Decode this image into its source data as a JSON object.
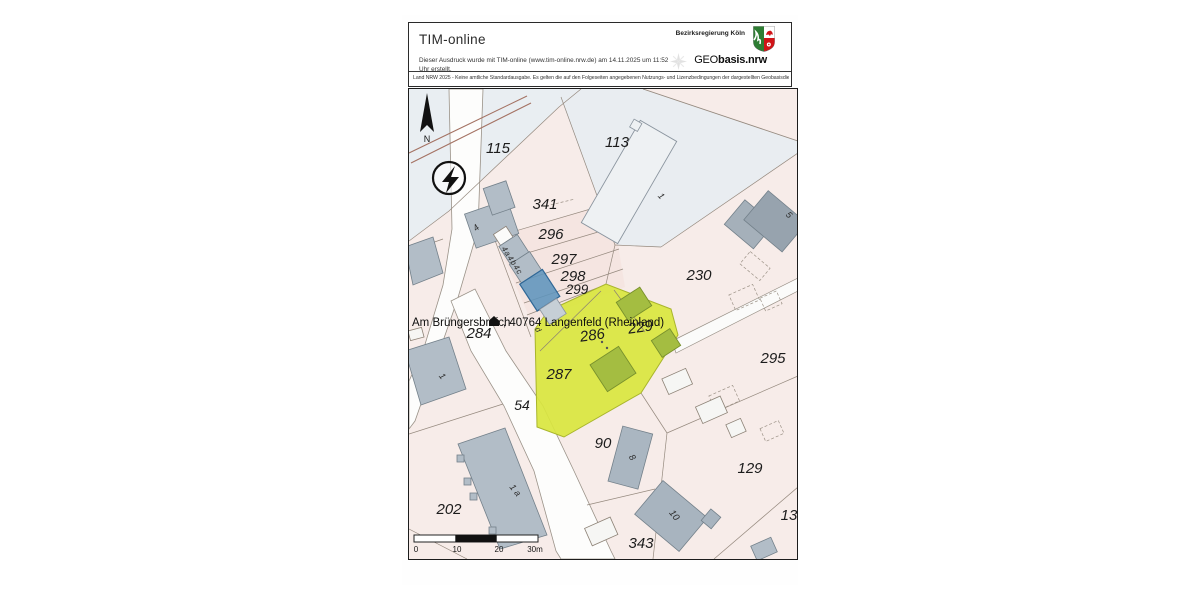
{
  "header": {
    "title": "TIM-online",
    "print_note_line1": "Dieser Ausdruck wurde mit TIM-online (www.tim-online.nrw.de) am 14.11.2025 um 11:52",
    "print_note_line2": "Uhr erstellt.",
    "agency": "Bezirksregierung Köln",
    "logo_prefix": "GEO",
    "logo_suffix": "basis.nrw",
    "disclaimer": "Land NRW 2025 - Keine amtliche Standardausgabe. Es gelten die auf den Folgeseiten angegebenen Nutzungs- und Lizenzbedingungen der dargestellten Geobasisdienste."
  },
  "map": {
    "north_label": "N",
    "address": {
      "part1": "Am Brüngersbroich",
      "part2": ", 40764 Langenfeld (Rheinland)",
      "marker_icon": "house-marker-icon"
    },
    "colors": {
      "parcel_pink": "#f7ece9",
      "street_area_blue": "#e9eef2",
      "highlight_parcels_yellow": "#d9e63e",
      "highlight_building_blue": "#5e94bc",
      "building_gray": "#b2bdc7",
      "building_in_highlight_olive": "#a4bd41"
    },
    "parcel_labels": [
      {
        "text": "115",
        "x": 89,
        "y": 64
      },
      {
        "text": "113",
        "x": 208,
        "y": 58
      },
      {
        "text": "341",
        "x": 136,
        "y": 120
      },
      {
        "text": "296",
        "x": 142,
        "y": 150
      },
      {
        "text": "297",
        "x": 155,
        "y": 175
      },
      {
        "text": "298",
        "x": 164,
        "y": 192
      },
      {
        "text": "299",
        "x": 168,
        "y": 205,
        "size": 13.5
      },
      {
        "text": "230",
        "x": 290,
        "y": 191
      },
      {
        "text": "284",
        "x": 70,
        "y": 249
      },
      {
        "text": "286",
        "x": 184,
        "y": 251,
        "rot": -8
      },
      {
        "text": "229",
        "x": 232,
        "y": 243,
        "rot": -8
      },
      {
        "text": "295",
        "x": 364,
        "y": 274
      },
      {
        "text": "287",
        "x": 150,
        "y": 290
      },
      {
        "text": "54",
        "x": 113,
        "y": 321,
        "size": 14
      },
      {
        "text": "90",
        "x": 194,
        "y": 359
      },
      {
        "text": "129",
        "x": 341,
        "y": 384
      },
      {
        "text": "202",
        "x": 40,
        "y": 425
      },
      {
        "text": "343",
        "x": 232,
        "y": 459
      },
      {
        "text": "13",
        "x": 380,
        "y": 431
      }
    ],
    "house_numbers": [
      {
        "text": "4",
        "x": 69,
        "y": 141,
        "rot": -42
      },
      {
        "text": "1",
        "x": 250,
        "y": 109,
        "rot": 48
      },
      {
        "text": "5",
        "x": 378,
        "y": 128,
        "rot": 44
      },
      {
        "text": "4a4b4c",
        "x": 101,
        "y": 173,
        "rot": 57,
        "size": 8,
        "ls": 1
      },
      {
        "text": "d",
        "x": 127,
        "y": 242,
        "rot": 57,
        "size": 8
      },
      {
        "text": "1",
        "x": 31,
        "y": 289,
        "rot": 52
      },
      {
        "text": "1 a",
        "x": 104,
        "y": 403,
        "rot": 52
      },
      {
        "text": "8",
        "x": 221,
        "y": 370,
        "rot": 55
      },
      {
        "text": "10",
        "x": 263,
        "y": 428,
        "rot": 52,
        "size": 9.5
      }
    ],
    "scale_bar": {
      "ticks": [
        {
          "label": "0",
          "x": 2,
          "y": 17
        },
        {
          "label": "10",
          "x": 43,
          "y": 17
        },
        {
          "label": "20",
          "x": 85,
          "y": 17
        },
        {
          "label": "30m",
          "x": 121,
          "y": 17
        }
      ]
    }
  }
}
